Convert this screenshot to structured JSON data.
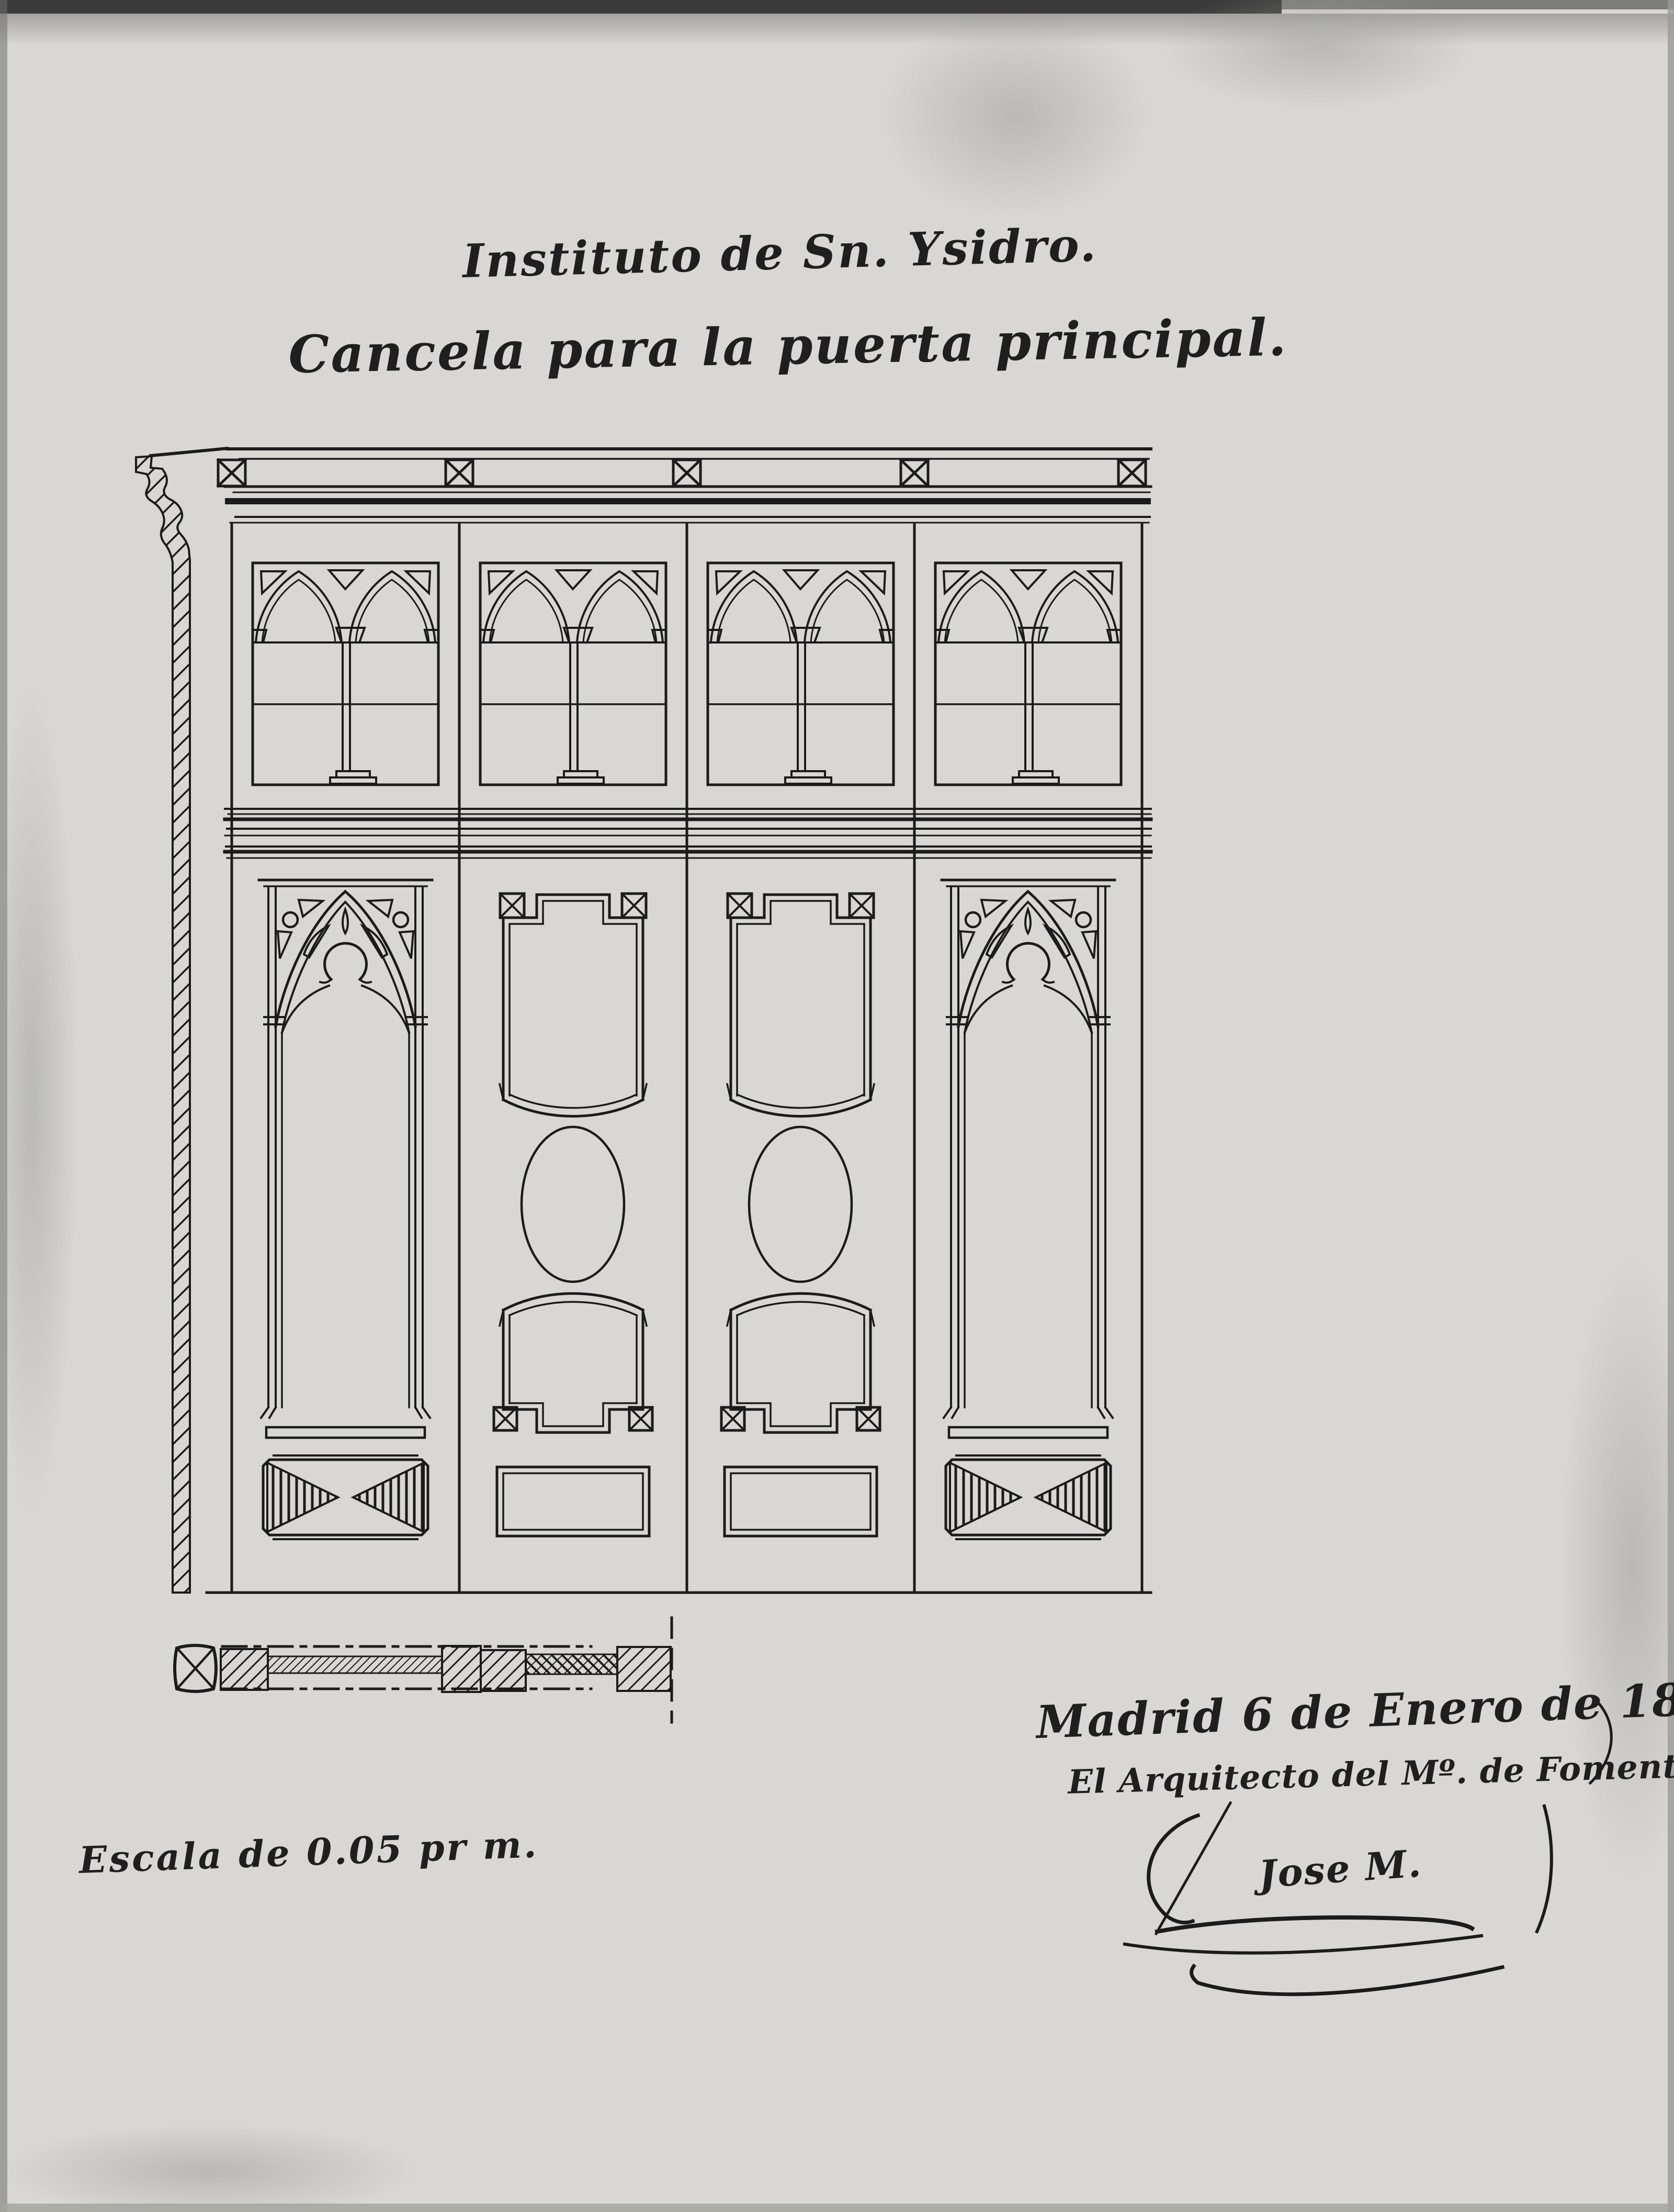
{
  "document": {
    "title_line1": "Instituto de Sn. Ysidro.",
    "title_line2": "Cancela para la puerta principal.",
    "date_line": "Madrid 6 de Enero de 1895.",
    "credit_line": "El Arquitecto del Mº. de Fomento.",
    "signature": "Jose M.",
    "scale_note": "Escala de 0.05 pr m."
  },
  "colors": {
    "paper": "#d8d7d3",
    "ink": "#1b1b1b",
    "scan_edge_dark": "#3a3a3a",
    "scan_shadow": "#a9a9a5"
  }
}
